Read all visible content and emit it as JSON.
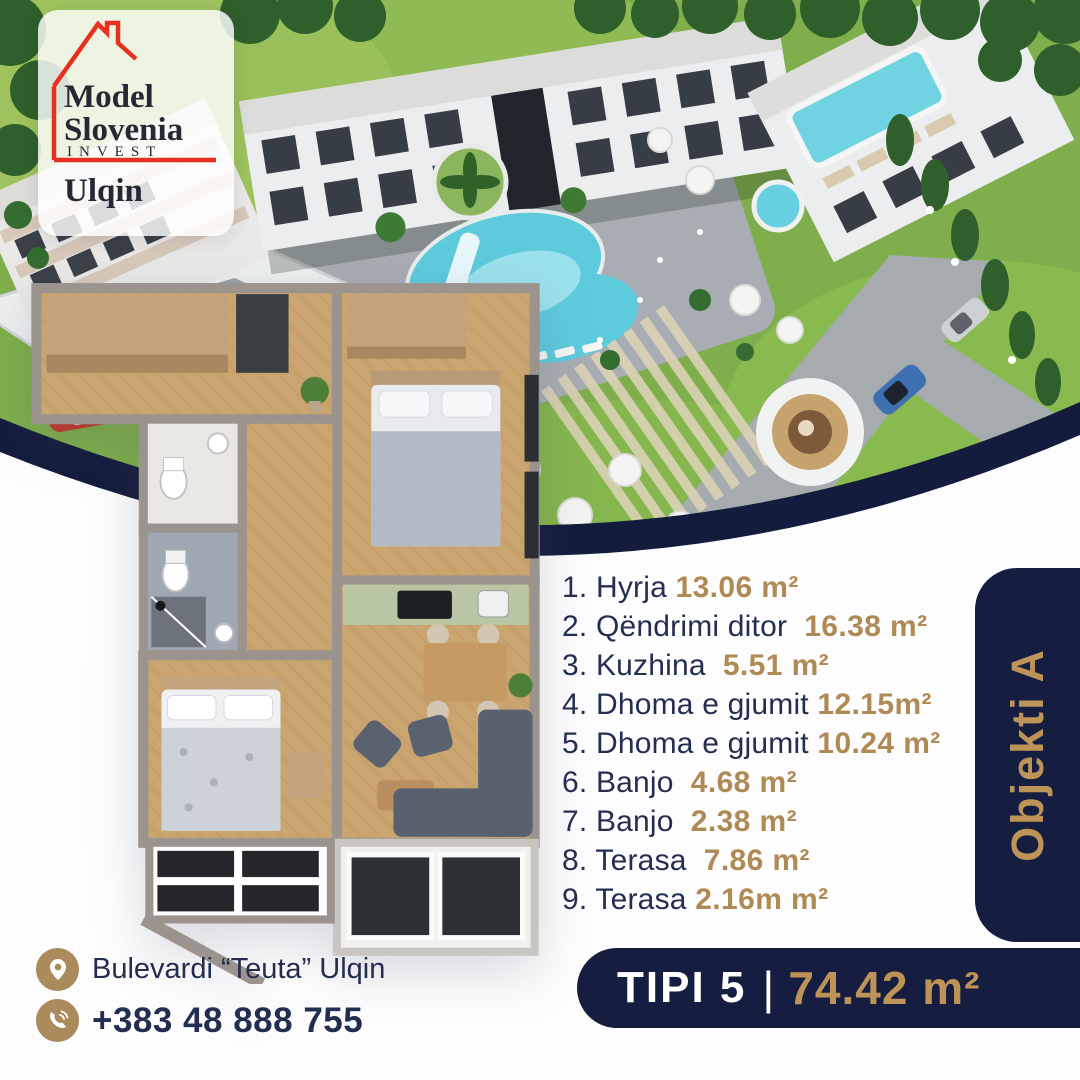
{
  "logo": {
    "brand_line1": "Model",
    "brand_line2": "Slovenia",
    "brand_line3": "INVEST",
    "brand_line4": "Ulqin"
  },
  "rooms": [
    {
      "label": "1. Hyrja ",
      "value": "13.06 m²"
    },
    {
      "label": "2. Qëndrimi ditor  ",
      "value": "16.38 m²"
    },
    {
      "label": "3. Kuzhina  ",
      "value": "5.51 m²"
    },
    {
      "label": "4. Dhoma e gjumit ",
      "value": "12.15m²"
    },
    {
      "label": "5. Dhoma e gjumit ",
      "value": "10.24 m²"
    },
    {
      "label": "6. Banjo  ",
      "value": "4.68 m²"
    },
    {
      "label": "7. Banjo  ",
      "value": "2.38 m²"
    },
    {
      "label": "8. Terasa  ",
      "value": "7.86 m²"
    },
    {
      "label": "9. Terasa ",
      "value": "2.16m m²"
    }
  ],
  "object_badge": {
    "label": "Objekti A"
  },
  "type_bar": {
    "type_label": "TIPI 5",
    "divider": "|",
    "area_value": "74.42 m²"
  },
  "contact": {
    "address": "Bulevardi “Teuta” Ulqin",
    "phone": "+383 48 888 755"
  },
  "icons": {
    "logo_house": "house-outline-icon",
    "address": "location-pin-icon",
    "phone": "phone-call-icon"
  },
  "colors": {
    "navy": "#151d40",
    "gold": "#b78e59",
    "accent_red": "#e8301f",
    "pool_blue": "#5ecbdd",
    "grass_green": "#7fae4c"
  }
}
